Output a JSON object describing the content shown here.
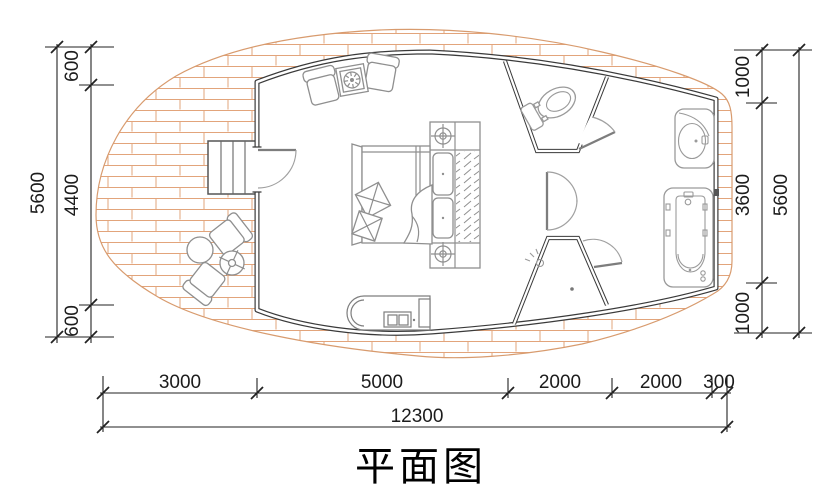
{
  "title": "平面图",
  "palette": {
    "wall_line": "#3a3a3a",
    "furniture_line": "#8f8f8f",
    "fixture_line": "#9a9a9a",
    "brick_line": "#e2a47b",
    "brick_edge": "#d89b6e",
    "dimension_line": "#222222",
    "paper": "#ffffff"
  },
  "dimensions": {
    "left": {
      "overall": "5600",
      "segments": [
        "600",
        "4400",
        "600"
      ]
    },
    "right": {
      "overall": "5600",
      "segments": [
        "1000",
        "3600",
        "1000"
      ]
    },
    "bottom": {
      "overall": "12300",
      "segments": [
        "3000",
        "5000",
        "2000",
        "2000",
        "300"
      ]
    }
  },
  "fixtures": {
    "deck": "brick-paved deck",
    "stairs": "entry stairs",
    "entry_door": "entry door",
    "armchairs": "armchair pair with side table",
    "bed": "double bed",
    "headboard": "headboard with bedside lamps",
    "wardrobe": "hatched wardrobe strip",
    "cabinet": "low cabinet",
    "toilet": "toilet compartment",
    "shower": "shower stall",
    "bathtub": "bathtub",
    "vanity": "vanity basin",
    "outdoor_set": "outdoor chairs and tables"
  }
}
